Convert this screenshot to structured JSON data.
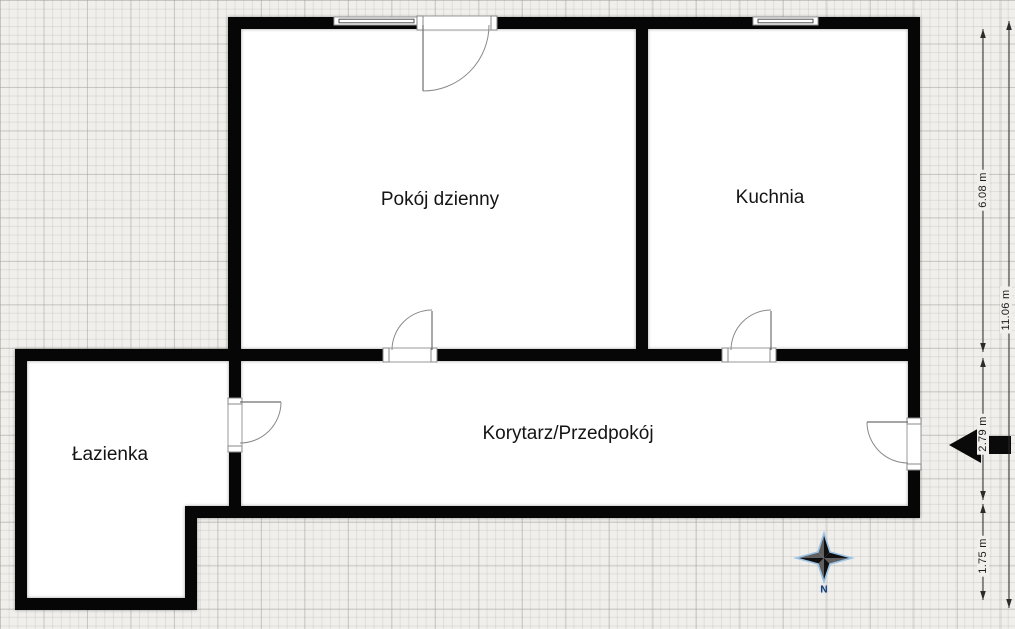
{
  "rooms": [
    {
      "label": "Pokój dzienny"
    },
    {
      "label": "Kuchnia"
    },
    {
      "label": "Korytarz/Przedpokój"
    },
    {
      "label": "Łazienka"
    }
  ],
  "dimensions": {
    "top_section_height": "6.08 m",
    "total_height": "11.06 m",
    "corridor_height": "2.79 m",
    "bottom_section_height": "1.75 m"
  },
  "compass": {
    "north_label": "N"
  },
  "icons": {
    "entrance": "entrance-arrow-icon",
    "compass": "compass-rose-icon"
  },
  "colors": {
    "wall": "#060606",
    "room_fill": "#ffffff",
    "canvas_background": "#f0efec",
    "dimension_text": "#1c1c1c",
    "compass_outline": "#9cc3e5",
    "compass_dark": "#101010",
    "compass_mid": "#5f5f5f",
    "compass_label": "#16396e"
  }
}
